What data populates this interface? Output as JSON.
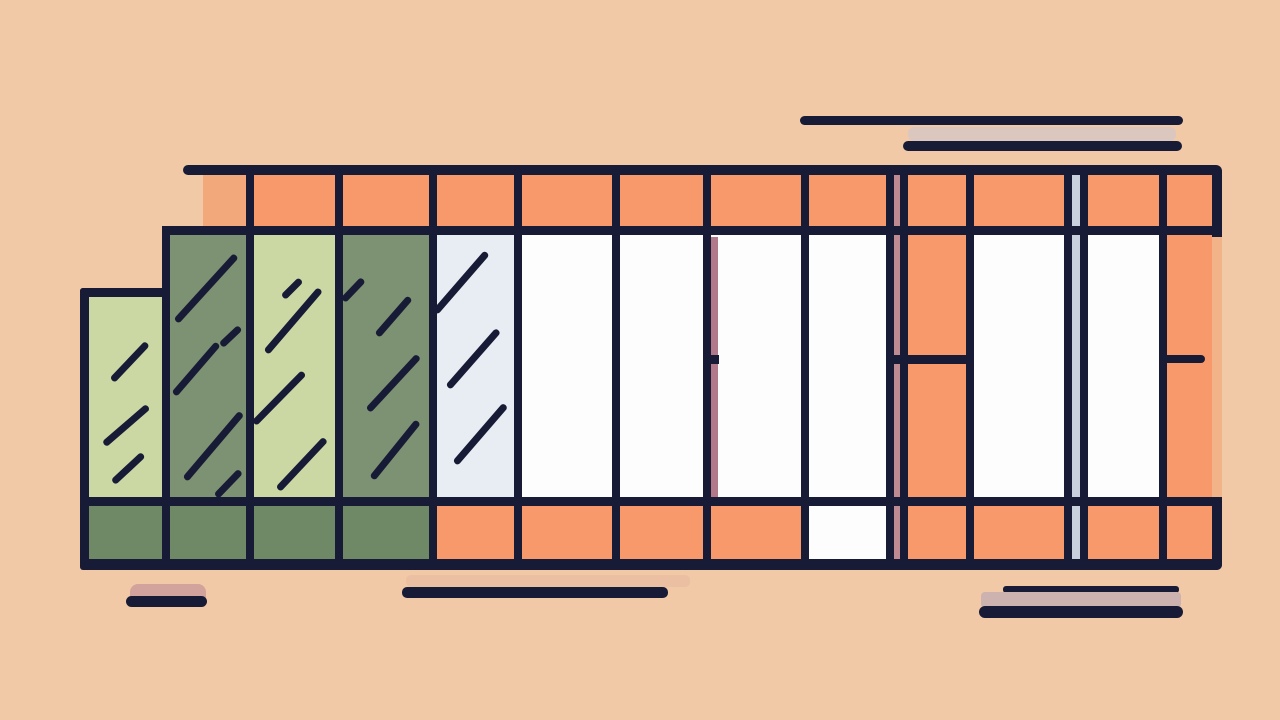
{
  "canvas": {
    "width": 1280,
    "height": 720,
    "background": "#f2c9a7"
  },
  "palette": {
    "bg": "#f2c9a7",
    "navy": "#181b36",
    "orange": "#f8996b",
    "orangeMutedBlock": "#f3a87b",
    "orangeMutedStrip": "#f2b389",
    "greenLight": "#ccd8a3",
    "sage": "#7d9272",
    "sageDark": "#6f8967",
    "paleBlue": "#e8edf4",
    "white": "#fdfdfe",
    "pinkStripe": "#c08a92",
    "mauveStripe": "#b2798b",
    "grayBlueStripe": "#c9d0dd",
    "decorGray": "#d8c6c1",
    "decorMauve": "#cdb3af",
    "decorPink": "#d2a39c",
    "shadowMid": "#e6bb9e"
  },
  "shapes": [
    {
      "n": "decor-line-top-long",
      "t": "rect",
      "x": 800,
      "y": 116,
      "w": 383,
      "h": 9,
      "c": "navy",
      "r": "5px"
    },
    {
      "n": "decor-shadow-band-top",
      "t": "rect",
      "x": 908,
      "y": 127,
      "w": 268,
      "h": 14,
      "c": "decorGray",
      "r": "6px",
      "o": 0.9
    },
    {
      "n": "decor-line-top-short",
      "t": "rect",
      "x": 903,
      "y": 141,
      "w": 279,
      "h": 10,
      "c": "navy",
      "r": "5px"
    },
    {
      "n": "roof-band-muted-block",
      "t": "rect",
      "x": 203,
      "y": 175,
      "w": 47,
      "h": 53,
      "c": "orangeMutedBlock"
    },
    {
      "n": "roof-band-fill",
      "t": "rect",
      "x": 250,
      "y": 175,
      "w": 962,
      "h": 55,
      "c": "orange"
    },
    {
      "n": "right-frame-shadow-strip",
      "t": "rect",
      "x": 1200,
      "y": 237,
      "w": 22,
      "h": 269,
      "c": "orangeMutedStrip"
    },
    {
      "n": "panel-1-fill",
      "t": "rect",
      "x": 84,
      "y": 292,
      "w": 82,
      "h": 214,
      "c": "greenLight"
    },
    {
      "n": "panel-2-fill",
      "t": "rect",
      "x": 166,
      "y": 230,
      "w": 84,
      "h": 276,
      "c": "sage"
    },
    {
      "n": "panel-3-fill",
      "t": "rect",
      "x": 250,
      "y": 230,
      "w": 89,
      "h": 276,
      "c": "greenLight"
    },
    {
      "n": "panel-4-fill",
      "t": "rect",
      "x": 339,
      "y": 230,
      "w": 94,
      "h": 276,
      "c": "sage"
    },
    {
      "n": "panel-5-fill",
      "t": "rect",
      "x": 433,
      "y": 230,
      "w": 85,
      "h": 276,
      "c": "paleBlue"
    },
    {
      "n": "panel-6-fill",
      "t": "rect",
      "x": 518,
      "y": 230,
      "w": 98,
      "h": 276,
      "c": "white"
    },
    {
      "n": "panel-7-fill",
      "t": "rect",
      "x": 616,
      "y": 230,
      "w": 89,
      "h": 276,
      "c": "white"
    },
    {
      "n": "panel-8-fill",
      "t": "rect",
      "x": 705,
      "y": 230,
      "w": 100,
      "h": 276,
      "c": "white"
    },
    {
      "n": "panel-9-fill",
      "t": "rect",
      "x": 805,
      "y": 230,
      "w": 85,
      "h": 276,
      "c": "white"
    },
    {
      "n": "panel-10-orange-bay-fill",
      "t": "rect",
      "x": 890,
      "y": 230,
      "w": 80,
      "h": 276,
      "c": "orange"
    },
    {
      "n": "panel-11-fill",
      "t": "rect",
      "x": 970,
      "y": 230,
      "w": 98,
      "h": 276,
      "c": "white"
    },
    {
      "n": "panel-12-fill",
      "t": "rect",
      "x": 1068,
      "y": 230,
      "w": 95,
      "h": 276,
      "c": "white"
    },
    {
      "n": "panel-13-orange-bay-fill",
      "t": "rect",
      "x": 1163,
      "y": 230,
      "w": 49,
      "h": 276,
      "c": "orange"
    },
    {
      "n": "base-band-orange-fill",
      "t": "rect",
      "x": 84,
      "y": 506,
      "w": 1128,
      "h": 53,
      "c": "orange"
    },
    {
      "n": "base-band-sage-fill",
      "t": "rect",
      "x": 84,
      "y": 506,
      "w": 349,
      "h": 53,
      "c": "sageDark"
    },
    {
      "n": "base-band-white-cell",
      "t": "rect",
      "x": 805,
      "y": 506,
      "w": 85,
      "h": 53,
      "c": "white"
    },
    {
      "n": "pink-shadow-stripe",
      "t": "rect",
      "x": 894,
      "y": 175,
      "w": 6,
      "h": 384,
      "c": "pinkStripe"
    },
    {
      "n": "grayblue-shadow-stripe",
      "t": "rect",
      "x": 1072,
      "y": 175,
      "w": 8,
      "h": 384,
      "c": "grayBlueStripe"
    },
    {
      "n": "mauve-shadow-stripe",
      "t": "rect",
      "x": 711,
      "y": 237,
      "w": 7,
      "h": 269,
      "c": "mauveStripe"
    },
    {
      "n": "hatch-p1-1",
      "t": "stroke",
      "x1": 112,
      "y1": 380,
      "x2": 147,
      "y2": 343,
      "w": 6.5,
      "c": "navy"
    },
    {
      "n": "hatch-p1-2",
      "t": "stroke",
      "x1": 104,
      "y1": 444,
      "x2": 148,
      "y2": 406,
      "w": 6.5,
      "c": "navy"
    },
    {
      "n": "hatch-p1-3",
      "t": "stroke",
      "x1": 113,
      "y1": 482,
      "x2": 143,
      "y2": 454,
      "w": 6.5,
      "c": "navy"
    },
    {
      "n": "hatch-p2-1",
      "t": "stroke",
      "x1": 176,
      "y1": 321,
      "x2": 236,
      "y2": 255,
      "w": 6.5,
      "c": "navy"
    },
    {
      "n": "hatch-p2-2",
      "t": "stroke",
      "x1": 174,
      "y1": 394,
      "x2": 218,
      "y2": 343,
      "w": 6.5,
      "c": "navy"
    },
    {
      "n": "hatch-p2-3",
      "t": "stroke",
      "x1": 221,
      "y1": 345,
      "x2": 240,
      "y2": 327,
      "w": 6.5,
      "c": "navy"
    },
    {
      "n": "hatch-p2-4",
      "t": "stroke",
      "x1": 185,
      "y1": 479,
      "x2": 241,
      "y2": 413,
      "w": 6.5,
      "c": "navy"
    },
    {
      "n": "hatch-p2-5",
      "t": "stroke",
      "x1": 216,
      "y1": 496,
      "x2": 240,
      "y2": 471,
      "w": 6.5,
      "c": "navy"
    },
    {
      "n": "hatch-p3-1",
      "t": "stroke",
      "x1": 283,
      "y1": 297,
      "x2": 301,
      "y2": 279,
      "w": 6.5,
      "c": "navy"
    },
    {
      "n": "hatch-p3-2",
      "t": "stroke",
      "x1": 266,
      "y1": 352,
      "x2": 320,
      "y2": 289,
      "w": 6.5,
      "c": "navy"
    },
    {
      "n": "hatch-p3-3",
      "t": "stroke",
      "x1": 254,
      "y1": 423,
      "x2": 304,
      "y2": 372,
      "w": 6.5,
      "c": "navy"
    },
    {
      "n": "hatch-p3-4",
      "t": "stroke",
      "x1": 278,
      "y1": 489,
      "x2": 325,
      "y2": 439,
      "w": 6.5,
      "c": "navy"
    },
    {
      "n": "hatch-p4-1",
      "t": "stroke",
      "x1": 343,
      "y1": 300,
      "x2": 363,
      "y2": 279,
      "w": 6.5,
      "c": "navy"
    },
    {
      "n": "hatch-p4-2",
      "t": "stroke",
      "x1": 377,
      "y1": 335,
      "x2": 410,
      "y2": 297,
      "w": 6.5,
      "c": "navy"
    },
    {
      "n": "hatch-p4-3",
      "t": "stroke",
      "x1": 368,
      "y1": 410,
      "x2": 418,
      "y2": 356,
      "w": 6.5,
      "c": "navy"
    },
    {
      "n": "hatch-p4-4",
      "t": "stroke",
      "x1": 372,
      "y1": 478,
      "x2": 418,
      "y2": 421,
      "w": 6.5,
      "c": "navy"
    },
    {
      "n": "hatch-p5-1",
      "t": "stroke",
      "x1": 435,
      "y1": 312,
      "x2": 487,
      "y2": 252,
      "w": 6.5,
      "c": "navy"
    },
    {
      "n": "hatch-p5-2",
      "t": "stroke",
      "x1": 448,
      "y1": 387,
      "x2": 498,
      "y2": 330,
      "w": 6.5,
      "c": "navy"
    },
    {
      "n": "hatch-p5-3",
      "t": "stroke",
      "x1": 455,
      "y1": 463,
      "x2": 505,
      "y2": 405,
      "w": 6.5,
      "c": "navy"
    },
    {
      "n": "frame-left-edge",
      "t": "rect",
      "x": 80,
      "y": 288,
      "w": 9,
      "h": 282,
      "c": "navy",
      "r": "3px"
    },
    {
      "n": "mullion-166",
      "t": "rect",
      "x": 162,
      "y": 226,
      "w": 8,
      "h": 344,
      "c": "navy"
    },
    {
      "n": "mullion-250",
      "t": "rect",
      "x": 246,
      "y": 170,
      "w": 8,
      "h": 400,
      "c": "navy"
    },
    {
      "n": "mullion-339",
      "t": "rect",
      "x": 335,
      "y": 170,
      "w": 8,
      "h": 400,
      "c": "navy"
    },
    {
      "n": "mullion-433",
      "t": "rect",
      "x": 429,
      "y": 170,
      "w": 8,
      "h": 400,
      "c": "navy"
    },
    {
      "n": "mullion-518",
      "t": "rect",
      "x": 514,
      "y": 170,
      "w": 8,
      "h": 400,
      "c": "navy"
    },
    {
      "n": "mullion-616",
      "t": "rect",
      "x": 612,
      "y": 170,
      "w": 8,
      "h": 400,
      "c": "navy"
    },
    {
      "n": "mullion-705",
      "t": "rect",
      "x": 703,
      "y": 170,
      "w": 8,
      "h": 400,
      "c": "navy"
    },
    {
      "n": "mullion-805",
      "t": "rect",
      "x": 801,
      "y": 170,
      "w": 8,
      "h": 400,
      "c": "navy"
    },
    {
      "n": "mullion-890a",
      "t": "rect",
      "x": 886,
      "y": 170,
      "w": 8,
      "h": 400,
      "c": "navy"
    },
    {
      "n": "mullion-890b",
      "t": "rect",
      "x": 900,
      "y": 170,
      "w": 8,
      "h": 400,
      "c": "navy"
    },
    {
      "n": "mullion-970",
      "t": "rect",
      "x": 966,
      "y": 170,
      "w": 8,
      "h": 400,
      "c": "navy"
    },
    {
      "n": "mullion-1068a",
      "t": "rect",
      "x": 1064,
      "y": 170,
      "w": 8,
      "h": 400,
      "c": "navy"
    },
    {
      "n": "mullion-1068b",
      "t": "rect",
      "x": 1080,
      "y": 170,
      "w": 8,
      "h": 400,
      "c": "navy"
    },
    {
      "n": "mullion-1163",
      "t": "rect",
      "x": 1159,
      "y": 170,
      "w": 8,
      "h": 400,
      "c": "navy"
    },
    {
      "n": "top-rail",
      "t": "rect",
      "x": 183,
      "y": 165,
      "w": 1034,
      "h": 10,
      "c": "navy",
      "r": "5px"
    },
    {
      "n": "right-post-top",
      "t": "rect",
      "x": 1212,
      "y": 165,
      "w": 10,
      "h": 72,
      "c": "navy",
      "r": "0 6px 0 0"
    },
    {
      "n": "roof-band-bottom-line",
      "t": "rect",
      "x": 162,
      "y": 226,
      "w": 1060,
      "h": 9,
      "c": "navy"
    },
    {
      "n": "panel-1-top-line",
      "t": "rect",
      "x": 80,
      "y": 288,
      "w": 90,
      "h": 9,
      "c": "navy",
      "r": "3px"
    },
    {
      "n": "orange-bay-divider",
      "t": "rect",
      "x": 886,
      "y": 355,
      "w": 84,
      "h": 9,
      "c": "navy"
    },
    {
      "n": "right-bay-tick",
      "t": "rect",
      "x": 1159,
      "y": 355,
      "w": 46,
      "h": 8,
      "c": "navy",
      "r": "0 4px 4px 0"
    },
    {
      "n": "mauve-stripe-tick",
      "t": "rect",
      "x": 710,
      "y": 355,
      "w": 9,
      "h": 9,
      "c": "navy"
    },
    {
      "n": "base-band-top-line",
      "t": "rect",
      "x": 80,
      "y": 497,
      "w": 1142,
      "h": 9,
      "c": "navy"
    },
    {
      "n": "right-post-bottom",
      "t": "rect",
      "x": 1212,
      "y": 497,
      "w": 10,
      "h": 73,
      "c": "navy",
      "r": "0 0 6px 0"
    },
    {
      "n": "base-bottom-line",
      "t": "rect",
      "x": 80,
      "y": 559,
      "w": 1142,
      "h": 11,
      "c": "navy",
      "r": "5px"
    },
    {
      "n": "decor-pink-block",
      "t": "rect",
      "x": 130,
      "y": 584,
      "w": 76,
      "h": 18,
      "c": "decorPink",
      "r": "8px 8px 2px 2px"
    },
    {
      "n": "decor-line-bottom-left",
      "t": "rect",
      "x": 126,
      "y": 596,
      "w": 81,
      "h": 11,
      "c": "navy",
      "r": "6px"
    },
    {
      "n": "decor-shadow-band-mid",
      "t": "rect",
      "x": 406,
      "y": 575,
      "w": 284,
      "h": 12,
      "c": "shadowMid",
      "r": "5px",
      "o": 0.6
    },
    {
      "n": "decor-line-bottom-mid",
      "t": "rect",
      "x": 402,
      "y": 587,
      "w": 266,
      "h": 11,
      "c": "navy",
      "r": "5px"
    },
    {
      "n": "decor-line-bottom-right-thin",
      "t": "rect",
      "x": 1003,
      "y": 586,
      "w": 176,
      "h": 7,
      "c": "navy",
      "r": "3px"
    },
    {
      "n": "decor-shadow-band-right",
      "t": "rect",
      "x": 981,
      "y": 592,
      "w": 200,
      "h": 16,
      "c": "decorMauve",
      "r": "4px"
    },
    {
      "n": "decor-line-bottom-right-thick",
      "t": "rect",
      "x": 979,
      "y": 606,
      "w": 204,
      "h": 12,
      "c": "navy",
      "r": "6px"
    }
  ]
}
